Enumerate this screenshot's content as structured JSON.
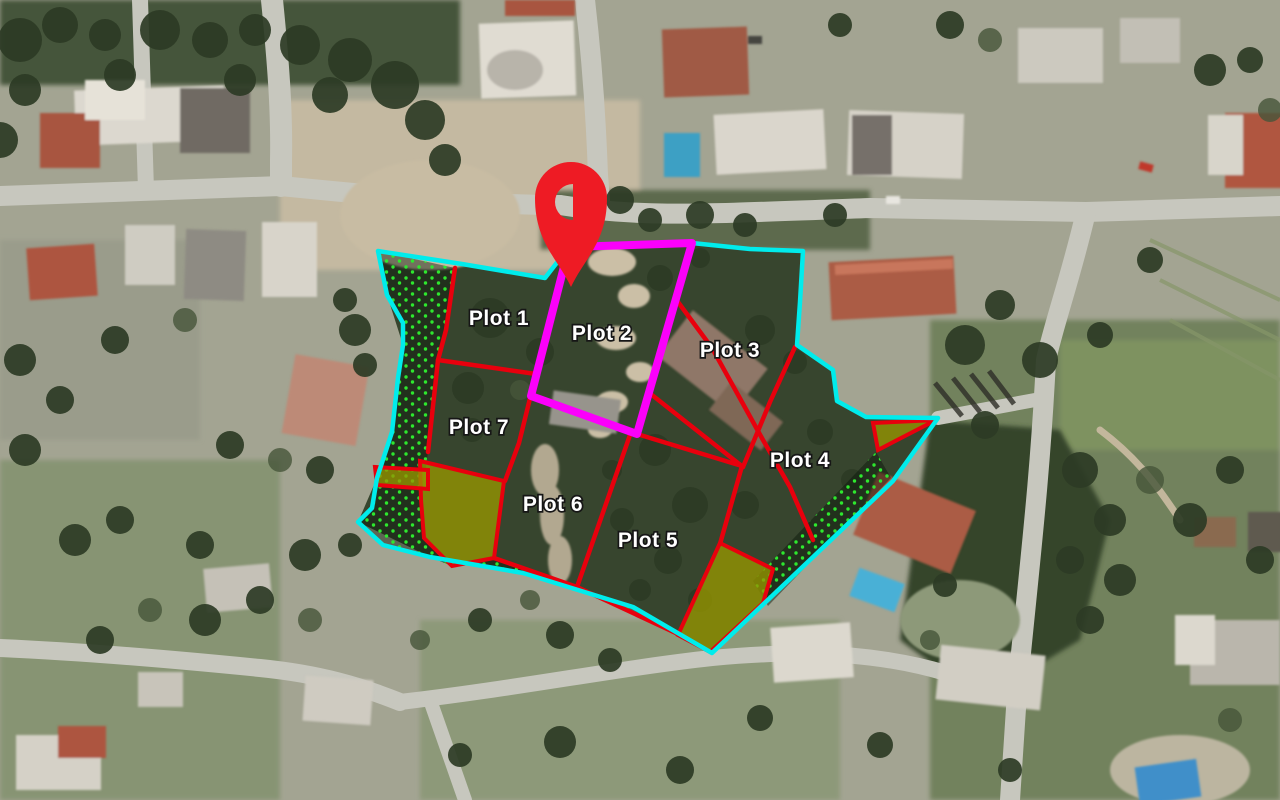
{
  "map": {
    "type": "satellite-plot-overlay",
    "colors": {
      "boundary_cyan": "#00ecec",
      "divider_red": "#e8000d",
      "highlight_magenta": "#fb00fb",
      "reserved_olive": "rgba(150,150,0,0.78)",
      "hatch_dot_green": "#2ee82e",
      "hatch_tint": "rgba(8,22,8,0.45)",
      "pin_red": "#ee1b24",
      "label_fill": "#ffffff",
      "label_outline": "#161616"
    },
    "labels": [
      {
        "id": "plot-1",
        "text": "Plot 1",
        "x": 499,
        "y": 325
      },
      {
        "id": "plot-2",
        "text": "Plot 2",
        "x": 602,
        "y": 340
      },
      {
        "id": "plot-3",
        "text": "Plot 3",
        "x": 730,
        "y": 357
      },
      {
        "id": "plot-4",
        "text": "Plot 4",
        "x": 800,
        "y": 467
      },
      {
        "id": "plot-5",
        "text": "Plot 5",
        "x": 648,
        "y": 547
      },
      {
        "id": "plot-6",
        "text": "Plot 6",
        "x": 553,
        "y": 511
      },
      {
        "id": "plot-7",
        "text": "Plot 7",
        "x": 479,
        "y": 434
      }
    ],
    "boundary": [
      [
        378,
        251
      ],
      [
        462,
        264
      ],
      [
        545,
        278
      ],
      [
        569,
        247
      ],
      [
        692,
        243
      ],
      [
        750,
        249
      ],
      [
        803,
        251
      ],
      [
        800,
        302
      ],
      [
        797,
        345
      ],
      [
        833,
        370
      ],
      [
        837,
        401
      ],
      [
        866,
        417
      ],
      [
        938,
        418
      ],
      [
        893,
        481
      ],
      [
        712,
        653
      ],
      [
        633,
        607
      ],
      [
        523,
        573
      ],
      [
        430,
        557
      ],
      [
        383,
        545
      ],
      [
        358,
        522
      ],
      [
        372,
        508
      ],
      [
        377,
        478
      ],
      [
        392,
        432
      ],
      [
        395,
        405
      ],
      [
        398,
        378
      ],
      [
        403,
        345
      ],
      [
        403,
        323
      ],
      [
        387,
        295
      ]
    ],
    "highlight": [
      [
        569,
        247
      ],
      [
        692,
        243
      ],
      [
        637,
        434
      ],
      [
        531,
        396
      ]
    ],
    "red_lines": [
      [
        [
          455,
          268
        ],
        [
          446,
          330
        ],
        [
          438,
          360
        ],
        [
          428,
          452
        ]
      ],
      [
        [
          438,
          360
        ],
        [
          536,
          374
        ]
      ],
      [
        [
          536,
          374
        ],
        [
          519,
          443
        ],
        [
          505,
          481
        ]
      ],
      [
        [
          494,
          558
        ],
        [
          577,
          587
        ],
        [
          678,
          634
        ]
      ],
      [
        [
          630,
          435
        ],
        [
          577,
          587
        ]
      ],
      [
        [
          637,
          434
        ],
        [
          742,
          466
        ]
      ],
      [
        [
          742,
          466
        ],
        [
          720,
          544
        ]
      ],
      [
        [
          678,
          302
        ],
        [
          712,
          348
        ],
        [
          737,
          393
        ],
        [
          763,
          440
        ],
        [
          790,
          487
        ],
        [
          813,
          540
        ]
      ],
      [
        [
          652,
          395
        ],
        [
          743,
          467
        ]
      ],
      [
        [
          795,
          347
        ],
        [
          770,
          402
        ],
        [
          743,
          467
        ]
      ]
    ],
    "olive_areas": [
      [
        [
          420,
          461
        ],
        [
          504,
          481
        ],
        [
          494,
          558
        ],
        [
          452,
          566
        ],
        [
          424,
          538
        ],
        [
          421,
          500
        ]
      ],
      [
        [
          720,
          543
        ],
        [
          773,
          569
        ],
        [
          763,
          603
        ],
        [
          710,
          652
        ],
        [
          678,
          635
        ]
      ],
      [
        [
          873,
          423
        ],
        [
          936,
          420
        ],
        [
          878,
          450
        ]
      ],
      [
        [
          375,
          467
        ],
        [
          428,
          470
        ],
        [
          428,
          489
        ],
        [
          377,
          485
        ]
      ]
    ],
    "hatch_areas": [
      [
        [
          378,
          251
        ],
        [
          455,
          268
        ],
        [
          446,
          330
        ],
        [
          438,
          360
        ],
        [
          428,
          452
        ],
        [
          421,
          500
        ],
        [
          424,
          538
        ],
        [
          452,
          566
        ],
        [
          430,
          557
        ],
        [
          383,
          545
        ],
        [
          358,
          522
        ],
        [
          372,
          508
        ],
        [
          377,
          478
        ],
        [
          392,
          432
        ],
        [
          395,
          405
        ],
        [
          398,
          378
        ],
        [
          403,
          345
        ],
        [
          403,
          323
        ],
        [
          387,
          295
        ]
      ],
      [
        [
          494,
          558
        ],
        [
          577,
          587
        ],
        [
          678,
          634
        ],
        [
          712,
          653
        ],
        [
          633,
          607
        ],
        [
          523,
          573
        ],
        [
          430,
          557
        ],
        [
          452,
          566
        ]
      ],
      [
        [
          876,
          452
        ],
        [
          891,
          478
        ],
        [
          768,
          606
        ],
        [
          753,
          581
        ]
      ]
    ],
    "pin": {
      "x": 571,
      "tip_y": 287,
      "head_cy": 198,
      "head_r": 36,
      "hole_cy": 202,
      "hole_r": 18
    }
  }
}
